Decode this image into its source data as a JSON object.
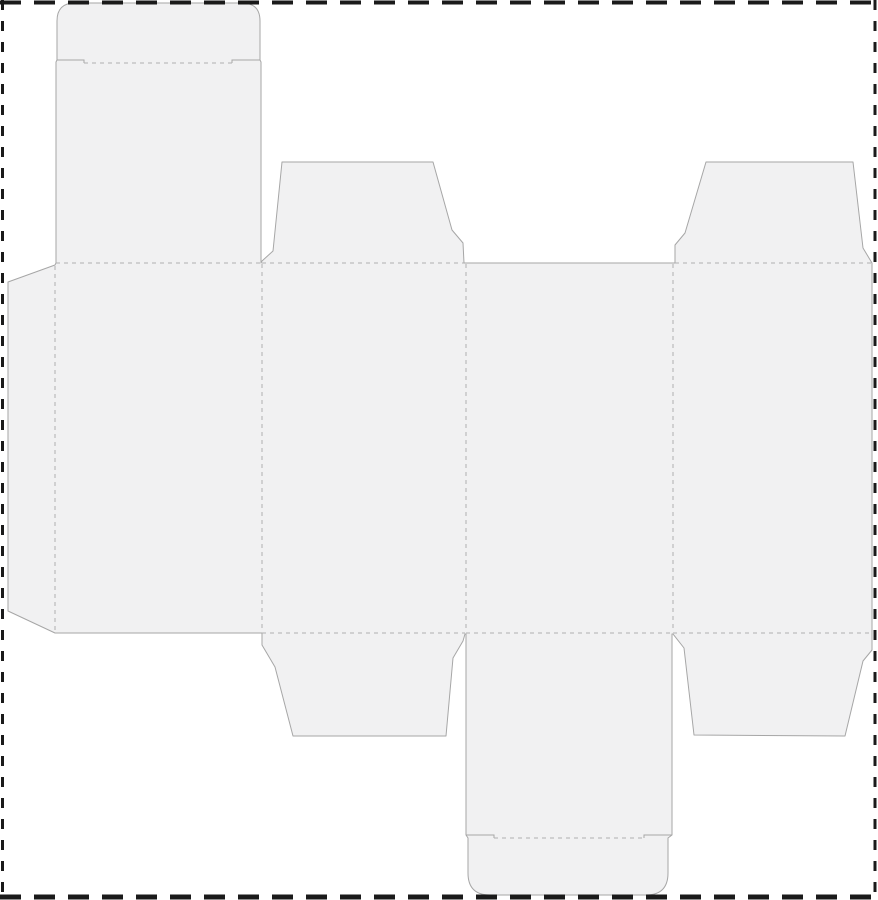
{
  "canvas": {
    "width": 878,
    "height": 900,
    "background_color": "#ffffff"
  },
  "page_border": {
    "color": "#1a1a1a",
    "edges": [
      {
        "name": "page-border-top",
        "x1": 0,
        "y1": 2.5,
        "x2": 878,
        "y2": 2.5,
        "thickness": 4,
        "dash": "21 13"
      },
      {
        "name": "page-border-bottom",
        "x1": 0,
        "y1": 897,
        "x2": 878,
        "y2": 897,
        "thickness": 5,
        "dash": "21 13"
      },
      {
        "name": "page-border-left",
        "x1": 2.5,
        "y1": 0,
        "x2": 2.5,
        "y2": 900,
        "thickness": 3,
        "dash": "10 11"
      },
      {
        "name": "page-border-right",
        "x1": 875,
        "y1": 0,
        "x2": 875,
        "y2": 900,
        "thickness": 3,
        "dash": "10 11"
      }
    ]
  },
  "dieline": {
    "fill_color": "#f1f1f2",
    "cut_color": "#a6a6a6",
    "fold_color": "#b0b0b0",
    "fold_dash": "4 4",
    "outline": {
      "name": "dieline-outline",
      "d": "M 57,21 Q 57,3 75,3 L 242,3 Q 260,3 260,21 L 260,60 L 261,62 L 261,263 L 262,261 L 273,251 L 282,162 L 433,162 L 452,230 L 463,243 L 464,263 L 673,263 L 675,263 L 675,245 L 685,233 L 706,162 L 853,162 L 863,248 L 872,263 L 872,650 L 863,661 L 845,736 L 694,735 L 684,648 L 673,634 L 672,634 L 672,835 L 668,838 L 668,873 Q 668,895 646,895 L 490,895 Q 468,895 468,873 L 468,838 L 466,835 L 466,634 L 465,634 L 463,641 L 453,658 L 446,736 L 293,736 L 275,667 L 262,645 L 262,634 L 262,633 L 55,633 L 8,611 L 8,282 L 55,265 L 56,263 L 56,62 L 57,60 Z"
    },
    "cut_slits": [
      {
        "name": "top-tuck-notch-left",
        "d": "M 57,60 L 84,60 L 84,63"
      },
      {
        "name": "top-tuck-notch-right",
        "d": "M 232,63 L 232,60 L 260,60"
      },
      {
        "name": "bottom-tuck-notch-left",
        "d": "M 466,835 L 494,835 L 494,838"
      },
      {
        "name": "bottom-tuck-notch-right",
        "d": "M 644,838 L 644,835 L 672,835"
      }
    ],
    "fold_lines": [
      {
        "name": "top-tuck-flap-fold",
        "d": "M 84,63 L 232,63"
      },
      {
        "name": "lid-panel1-fold",
        "d": "M 56,263 L 261,263"
      },
      {
        "name": "top-dust-flap-left-fold",
        "d": "M 262,263 L 464,263"
      },
      {
        "name": "top-dust-flap-right-fold",
        "d": "M 675,263 L 872,263"
      },
      {
        "name": "glue-flap-fold",
        "d": "M 55,266 L 55,630"
      },
      {
        "name": "fold-panel1-panel2",
        "d": "M 262,264 L 262,632"
      },
      {
        "name": "fold-panel2-panel3",
        "d": "M 466,264 L 466,632"
      },
      {
        "name": "fold-panel3-panel4",
        "d": "M 673,264 L 673,632"
      },
      {
        "name": "bottom-fold-panel2",
        "d": "M 262,633 L 465,633"
      },
      {
        "name": "bottom-fold-panel3",
        "d": "M 466,633 L 672,633"
      },
      {
        "name": "bottom-fold-panel4",
        "d": "M 673,633 L 872,633"
      },
      {
        "name": "bottom-tuck-flap-fold",
        "d": "M 494,838 L 644,838"
      }
    ]
  }
}
